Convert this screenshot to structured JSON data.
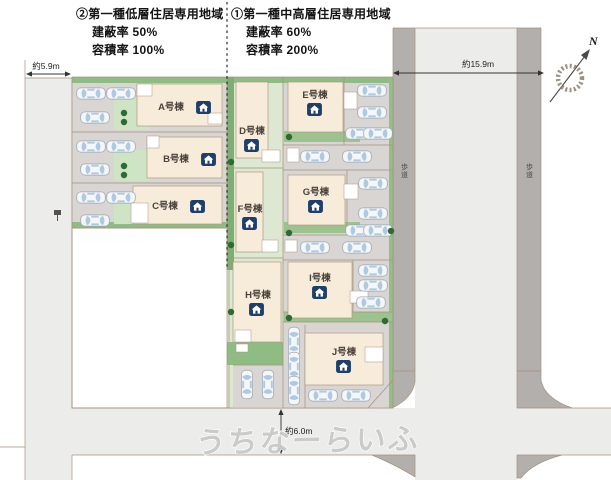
{
  "plan": {
    "zoning_left": {
      "title": "②第一種低層住居専用地域",
      "coverage_ratio": "建蔽率 50%",
      "floor_area_ratio": "容積率 100%"
    },
    "zoning_right": {
      "title": "①第一種中高層住居専用地域",
      "coverage_ratio": "建蔽率 60%",
      "floor_area_ratio": "容積率 200%"
    },
    "measurements": {
      "west_road": "約5.9m",
      "east_road": "約15.9m",
      "south_road": "約6.0m"
    },
    "sidewalk_label": "歩道",
    "compass_north": "N",
    "watermark": "うちなーらいふ",
    "buildings": [
      {
        "name": "A号棟"
      },
      {
        "name": "B号棟"
      },
      {
        "name": "C号棟"
      },
      {
        "name": "D号棟"
      },
      {
        "name": "E号棟"
      },
      {
        "name": "F号棟"
      },
      {
        "name": "G号棟"
      },
      {
        "name": "H号棟"
      },
      {
        "name": "I号棟"
      },
      {
        "name": "J号棟"
      }
    ],
    "colors": {
      "roadway": "#ececea",
      "sidewalk": "#b2afac",
      "parking": "#d8d5d2",
      "building": "#f6ecd9",
      "lawn": "#dce8d2",
      "hedge": "#8fbc82",
      "tree": "#2d6a34",
      "house_icon": "#1e3e6b",
      "border": "#a5907c",
      "watermark_gray": "#c9c9c9"
    }
  }
}
